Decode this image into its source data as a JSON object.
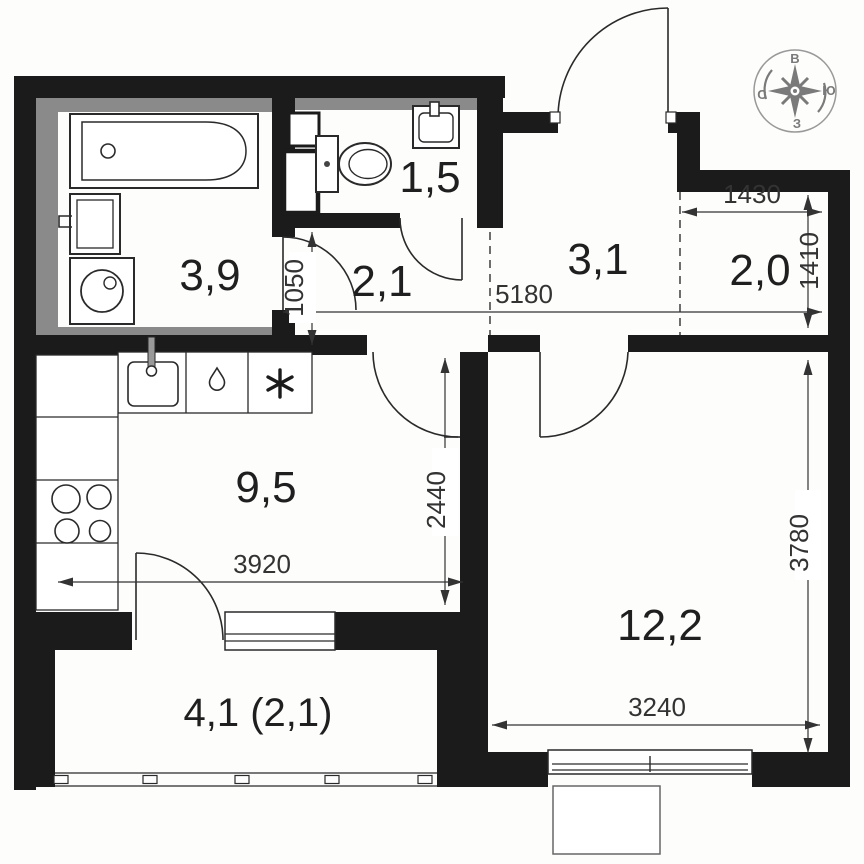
{
  "plan": {
    "title": "apartment-floor-plan",
    "rooms": [
      {
        "id": "bathroom",
        "area": "3,9"
      },
      {
        "id": "toilet",
        "area": "1,5"
      },
      {
        "id": "hall-small",
        "area": "2,1"
      },
      {
        "id": "hall",
        "area": "3,1"
      },
      {
        "id": "wardrobe",
        "area": "2,0"
      },
      {
        "id": "kitchen",
        "area": "9,5"
      },
      {
        "id": "living-room",
        "area": "12,2"
      },
      {
        "id": "balcony",
        "area": "4,1 (2,1)"
      }
    ],
    "dimensions_mm": [
      {
        "id": "wardrobe-width",
        "value": "1430"
      },
      {
        "id": "wardrobe-height",
        "value": "1410"
      },
      {
        "id": "hall-width",
        "value": "5180"
      },
      {
        "id": "corridor-width",
        "value": "1050"
      },
      {
        "id": "kitchen-depth",
        "value": "2440"
      },
      {
        "id": "kitchen-width",
        "value": "3920"
      },
      {
        "id": "living-height",
        "value": "3780"
      },
      {
        "id": "living-width",
        "value": "3240"
      }
    ],
    "compass": {
      "top": "В",
      "right": "Ю",
      "bottom": "З",
      "left": "С"
    },
    "fixtures": [
      "bathtub",
      "bath-sink",
      "washing-machine",
      "toilet",
      "corner-sink",
      "kitchen-sink",
      "drop",
      "snowflake",
      "stove",
      "window",
      "balcony-glazing"
    ],
    "colors": {
      "wall": "#1b1b1b",
      "shaft": "#8a8a8a",
      "dimension": "#333333",
      "compass": "#7a7a7a"
    }
  }
}
